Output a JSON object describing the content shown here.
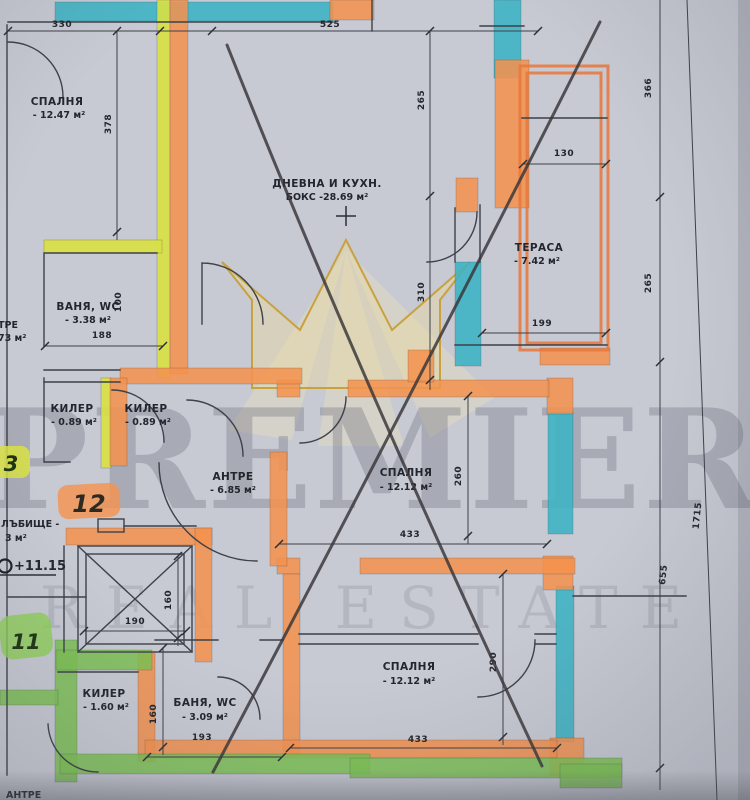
{
  "plan": {
    "rooms": {
      "bedroom_tl": {
        "name": "СПАЛНЯ",
        "area": "- 12.47 м²"
      },
      "living": {
        "name": "ДНЕВНА И КУХН.",
        "area": "БОКС -28.69 м²"
      },
      "terrace": {
        "name": "ТЕРАСА",
        "area": "- 7.42 м²"
      },
      "bath_top": {
        "name": "ВАНЯ, WC",
        "area": "- 3.38 м²"
      },
      "closet_a": {
        "name": "КИЛЕР",
        "area": "- 0.89 м²"
      },
      "closet_b": {
        "name": "КИЛЕР",
        "area": "- 0.89 м²"
      },
      "hall": {
        "name": "АНТРЕ",
        "area": "- 6.85 м²"
      },
      "bedroom_r": {
        "name": "СПАЛНЯ",
        "area": "- 12.12 м²"
      },
      "bedroom_b": {
        "name": "СПАЛНЯ",
        "area": "- 12.12 м²"
      },
      "closet_c": {
        "name": "КИЛЕР",
        "area": "- 1.60 м²"
      },
      "bath_bottom": {
        "name": "БАНЯ, WC",
        "area": "- 3.09 м²"
      }
    },
    "partial_labels": {
      "neighbor_hall": "ТРЕ",
      "neighbor_hall_area": "73 м²",
      "stairs": "ЛЪБИЩЕ -",
      "stairs_area": "3 м²",
      "bottom_cut": "АНТРЕ"
    },
    "apartment_numbers": {
      "current": "12",
      "below": "11",
      "left_partial": "3"
    },
    "level_mark": "+11.15",
    "dims": {
      "d330": "330",
      "d525": "525",
      "d265_top": "265",
      "d310": "310",
      "d378": "378",
      "d130": "130",
      "d199": "199",
      "d366": "366",
      "d265_right": "265",
      "d1715": "1715",
      "d655": "655",
      "d188": "188",
      "d100": "100",
      "d433_mid": "433",
      "d260": "260",
      "d190": "190",
      "d160_lift": "160",
      "d193": "193",
      "d433_bot": "433",
      "d160_bath": "160",
      "d290": "290"
    },
    "watermark": {
      "brand": "PREMIER",
      "tagline": "REAL ESTATE"
    }
  }
}
